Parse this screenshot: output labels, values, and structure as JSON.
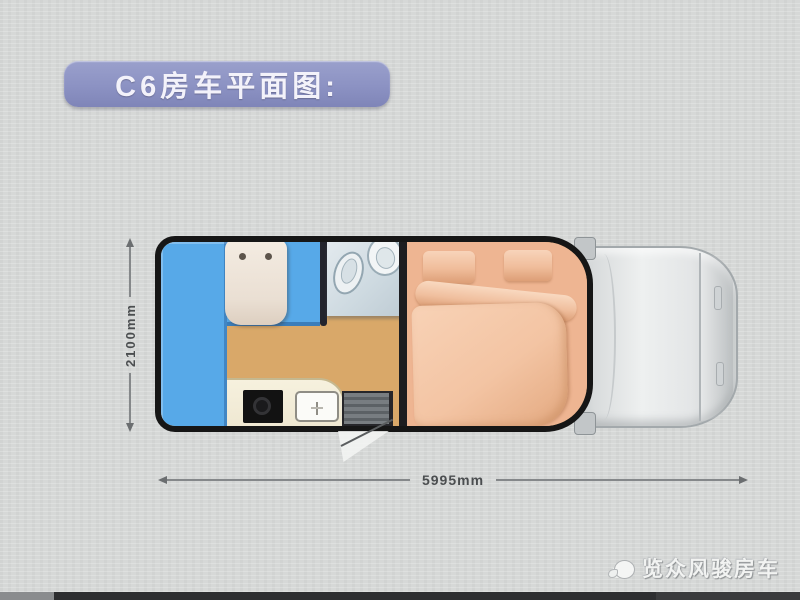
{
  "page": {
    "background_color": "#d6d8d7",
    "bottom_bar_color": "#2d2e30"
  },
  "title_banner": {
    "label": "C6房车平面图:",
    "bg_color": "#8c92c3",
    "text_color": "#f3f2fa"
  },
  "dimensions": {
    "height_label": "2100mm",
    "width_label": "5995mm",
    "line_color": "#85888a"
  },
  "floorplan": {
    "wall_color": "#161616",
    "areas": [
      {
        "name": "side-sofa",
        "color": "#57a9e8"
      },
      {
        "name": "seating-area",
        "color": "#57a9e8"
      },
      {
        "name": "dinette-seat",
        "color": "#eadfd3"
      },
      {
        "name": "wood-floor",
        "color": "#d9a869"
      },
      {
        "name": "bathroom",
        "color": "#cdd9e0",
        "fixtures": [
          "toilet",
          "wash-basin"
        ]
      },
      {
        "name": "double-bed",
        "color": "#eeb592",
        "items": [
          "pillow",
          "pillow",
          "blanket-roll",
          "duvet"
        ]
      },
      {
        "name": "kitchen-counter",
        "color": "#efe8d2",
        "items": [
          "cooktop",
          "sink"
        ]
      },
      {
        "name": "entry-step",
        "color": "#5c6165"
      },
      {
        "name": "entry-door-swing",
        "color": "#f5f6f4"
      }
    ]
  },
  "cab": {
    "name": "truck-cab-top-view",
    "body_color": "#e4e6e7",
    "outline_color": "#a3a9ac",
    "mirrors": 2
  },
  "watermark": {
    "label": "览众风骏房车",
    "logo_icon": "horse-cloud-logo",
    "text_color": "#f2f3f2"
  }
}
